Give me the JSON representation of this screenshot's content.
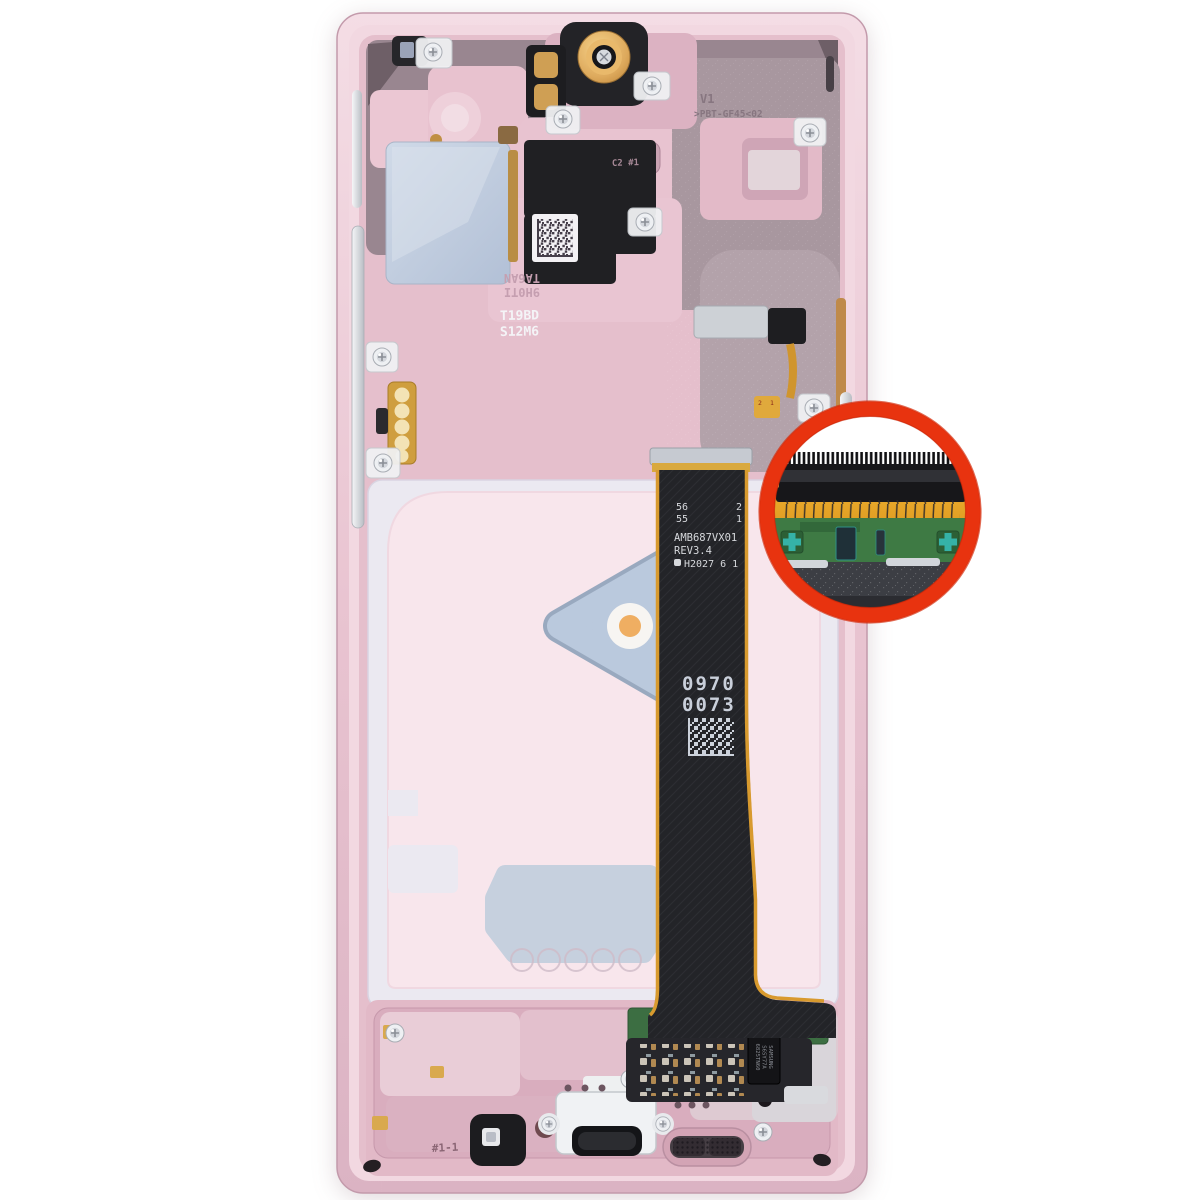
{
  "frame_markings": {
    "material_line1": "V1",
    "material_line2": ">PBT-GF45<02",
    "position_stamp": "C2 #1",
    "mold_stamp_line1": "T19BD",
    "mold_stamp_line2": "S12M6",
    "rotated_stamp_line1": "9H0TI",
    "rotated_stamp_line2": "TA6AN",
    "bottom_stamp": "#1-1"
  },
  "display_flex": {
    "pin_left_1": "56",
    "pin_left_2": "55",
    "pin_right_1": "2",
    "pin_right_2": "1",
    "model": "AMB687VX01",
    "revision": "REV3.4",
    "date_code": "H2027 6 1",
    "serial_line1": "0970",
    "serial_line2": "0073"
  },
  "sub_flex": {
    "pin_1": "2",
    "pin_2": "1"
  },
  "touch_ic": {
    "line1": "SAMSUNG",
    "line2": "S6SY77A",
    "line3": "6825TN60"
  },
  "colors": {
    "accent_ring": "#E8330F",
    "frame_pink": "#EDC9D6",
    "adhesive_pink": "#F8E6EC",
    "thermal_pad_blue": "#C3CFDD",
    "flex_black": "#232428",
    "flex_gold": "#E3A122",
    "pcb_green": "#3F7B45"
  }
}
